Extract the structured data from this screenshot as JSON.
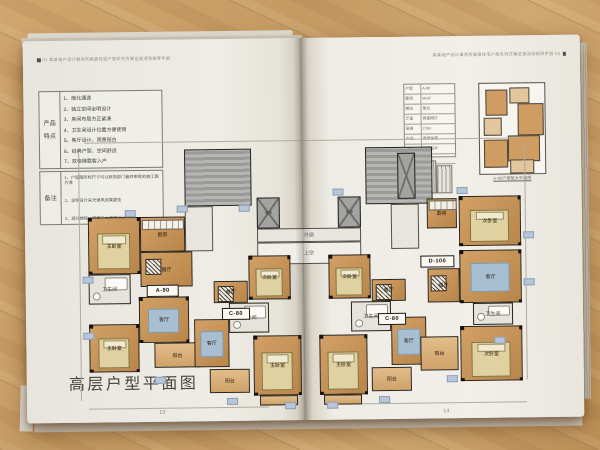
{
  "left_page": {
    "header": "01  某某地产设计事务所高层住宅户型系列方案征选活动指导手册",
    "page_number": "13",
    "title": "高层户型平面图",
    "features": {
      "label": "产品特点",
      "items": [
        "1、南北通透",
        "2、独立空间全明设计",
        "3、房间布局方正紧凑",
        "4、卫生间设计位置方便使用",
        "5、客厅设计、观景阳台",
        "6、经典户型、空间舒适",
        "7、双电梯载客入户"
      ]
    },
    "notes": {
      "label": "备注",
      "items": [
        "1、户型图所标尺寸均以政府部门最终审批的施工图为准",
        "2、全明设计采光通风效果更佳",
        "3、部分楼栋一梯两户大面宽设计"
      ]
    }
  },
  "right_page": {
    "header": "某某地产设计事务所高层住宅户型系列方案征选活动指导手册  02",
    "page_number": "14",
    "inset": {
      "caption": "A-90户型放大平面图",
      "table_rows": [
        [
          "户型",
          "A-90"
        ],
        [
          "面积",
          "90㎡"
        ],
        [
          "朝向",
          "南北"
        ],
        [
          "厅室",
          "两室两厅"
        ],
        [
          "层高",
          "2.9m"
        ],
        [
          "产品",
          "高层住宅"
        ],
        [
          "特点",
          "全明设计"
        ],
        [
          "备注",
          "—"
        ]
      ]
    }
  },
  "plan": {
    "blocks": [
      {
        "k": "core",
        "x": 160,
        "y": 110,
        "w": 67,
        "h": 57
      },
      {
        "k": "core",
        "x": 341,
        "y": 110,
        "w": 67,
        "h": 57
      },
      {
        "k": "shaft",
        "x": 373,
        "y": 116,
        "w": 18,
        "h": 46
      },
      {
        "k": "shaft",
        "x": 232,
        "y": 159,
        "w": 23,
        "h": 31,
        "label": "电梯"
      },
      {
        "k": "shaft",
        "x": 313,
        "y": 159,
        "w": 23,
        "h": 31,
        "label": "电梯"
      },
      {
        "k": "walk",
        "x": 232,
        "y": 190,
        "w": 104,
        "h": 14,
        "label": "外廊"
      },
      {
        "k": "void",
        "x": 232,
        "y": 204,
        "w": 104,
        "h": 22,
        "label": "上空"
      },
      {
        "k": "walk",
        "x": 160,
        "y": 167,
        "w": 28,
        "h": 45
      },
      {
        "k": "walk",
        "x": 366,
        "y": 167,
        "w": 28,
        "h": 45
      },
      {
        "k": "room",
        "label": "主卧室",
        "x": 63,
        "y": 177,
        "w": 52,
        "h": 57,
        "f": "bed"
      },
      {
        "k": "room",
        "label": "厨房",
        "x": 115,
        "y": 177,
        "w": 45,
        "h": 35,
        "f": "counter"
      },
      {
        "k": "room",
        "label": "餐厅",
        "x": 115,
        "y": 212,
        "w": 52,
        "h": 35,
        "f": "table"
      },
      {
        "k": "bath",
        "label": "卫生间",
        "x": 63,
        "y": 234,
        "w": 42,
        "h": 30,
        "f": "bath"
      },
      {
        "k": "room",
        "label": "客厅",
        "x": 113,
        "y": 257,
        "w": 50,
        "h": 46,
        "f": "rug"
      },
      {
        "k": "room",
        "label": "主卧室",
        "x": 63,
        "y": 284,
        "w": 50,
        "h": 48,
        "f": "bed"
      },
      {
        "k": "balcony",
        "label": "阳台",
        "x": 128,
        "y": 303,
        "w": 46,
        "h": 25
      },
      {
        "k": "room",
        "label": "餐厅",
        "x": 188,
        "y": 242,
        "w": 34,
        "h": 22,
        "f": "table"
      },
      {
        "k": "room",
        "label": "次卧室",
        "x": 223,
        "y": 217,
        "w": 42,
        "h": 44,
        "f": "bed"
      },
      {
        "k": "room",
        "label": "客厅",
        "x": 168,
        "y": 280,
        "w": 35,
        "h": 48,
        "f": "rug"
      },
      {
        "k": "bath",
        "label": "卫生间",
        "x": 203,
        "y": 264,
        "w": 40,
        "h": 30,
        "f": "bath"
      },
      {
        "k": "balcony",
        "label": "阳台",
        "x": 183,
        "y": 330,
        "w": 40,
        "h": 24
      },
      {
        "k": "room",
        "label": "主卧室",
        "x": 227,
        "y": 297,
        "w": 48,
        "h": 60,
        "f": "bed"
      },
      {
        "k": "balcony",
        "x": 233,
        "y": 357,
        "w": 38,
        "h": 10
      },
      {
        "k": "room",
        "label": "次卧室",
        "x": 303,
        "y": 217,
        "w": 42,
        "h": 44,
        "f": "bed"
      },
      {
        "k": "bath",
        "label": "卫生间",
        "x": 325,
        "y": 264,
        "w": 40,
        "h": 30,
        "f": "bath"
      },
      {
        "k": "room",
        "label": "主卧室",
        "x": 293,
        "y": 297,
        "w": 48,
        "h": 60,
        "f": "bed"
      },
      {
        "k": "balcony",
        "x": 297,
        "y": 357,
        "w": 38,
        "h": 10
      },
      {
        "k": "room",
        "label": "餐厅",
        "x": 346,
        "y": 242,
        "w": 34,
        "h": 22,
        "f": "table"
      },
      {
        "k": "room",
        "label": "客厅",
        "x": 365,
        "y": 280,
        "w": 35,
        "h": 48,
        "f": "rug"
      },
      {
        "k": "balcony",
        "label": "阳台",
        "x": 345,
        "y": 330,
        "w": 40,
        "h": 24
      },
      {
        "k": "room",
        "label": "厨房",
        "x": 402,
        "y": 162,
        "w": 30,
        "h": 30,
        "f": "counter"
      },
      {
        "k": "room",
        "label": "次卧室",
        "x": 434,
        "y": 160,
        "w": 62,
        "h": 50,
        "f": "bed"
      },
      {
        "k": "room",
        "label": "餐厅",
        "x": 402,
        "y": 232,
        "w": 32,
        "h": 34,
        "f": "table"
      },
      {
        "k": "room",
        "label": "客厅",
        "x": 434,
        "y": 214,
        "w": 62,
        "h": 53,
        "f": "rug"
      },
      {
        "k": "bath",
        "label": "卫生间",
        "x": 447,
        "y": 267,
        "w": 40,
        "h": 22,
        "f": "bath"
      },
      {
        "k": "balcony",
        "label": "阳台",
        "x": 394,
        "y": 300,
        "w": 38,
        "h": 34
      },
      {
        "k": "room",
        "label": "次卧室",
        "x": 434,
        "y": 290,
        "w": 62,
        "h": 55,
        "f": "bed"
      }
    ],
    "unit_labels": [
      {
        "t": "A-90",
        "x": 121,
        "y": 245,
        "w": 30
      },
      {
        "t": "C-80",
        "x": 196,
        "y": 269,
        "w": 26
      },
      {
        "t": "D-100",
        "x": 395,
        "y": 219,
        "w": 32
      },
      {
        "t": "C-80",
        "x": 352,
        "y": 276,
        "w": 26
      }
    ],
    "dim_marks": [
      [
        100,
        170
      ],
      [
        152,
        166
      ],
      [
        214,
        166
      ],
      [
        57,
        236
      ],
      [
        57,
        292
      ],
      [
        128,
        337
      ],
      [
        200,
        359
      ],
      [
        258,
        364
      ],
      [
        300,
        364
      ],
      [
        352,
        359
      ],
      [
        420,
        339
      ],
      [
        468,
        301
      ],
      [
        498,
        243
      ],
      [
        498,
        196
      ],
      [
        432,
        151
      ],
      [
        308,
        151
      ]
    ],
    "dim_lines": [
      [
        60,
        102,
        438,
        1
      ],
      [
        54,
        112,
        1,
        248
      ],
      [
        500,
        108,
        1,
        236
      ],
      [
        62,
        368,
        180,
        1
      ],
      [
        335,
        366,
        165,
        1
      ]
    ],
    "mini_rooms": [
      [
        6,
        6,
        20,
        24,
        "t"
      ],
      [
        30,
        4,
        18,
        14,
        "l"
      ],
      [
        38,
        20,
        24,
        30,
        "t"
      ],
      [
        4,
        34,
        16,
        16,
        "l"
      ],
      [
        28,
        52,
        30,
        24,
        "t"
      ],
      [
        4,
        56,
        22,
        26,
        "t"
      ],
      [
        30,
        76,
        22,
        12,
        "l"
      ]
    ]
  }
}
